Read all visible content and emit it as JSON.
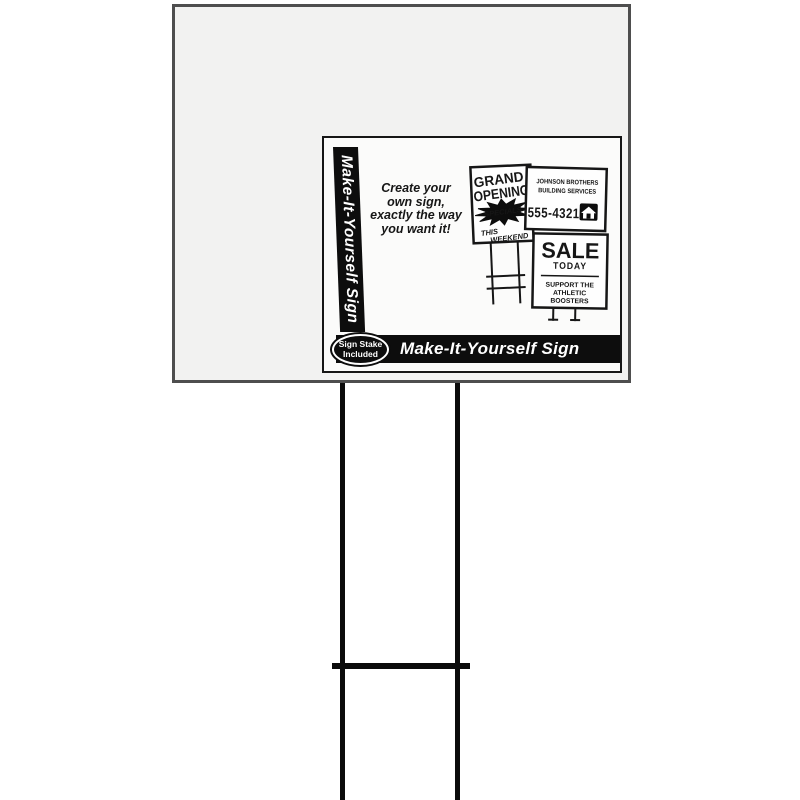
{
  "colors": {
    "background": "#ffffff",
    "sign_fill": "#f2f2f1",
    "label_fill": "#fbfbfa",
    "ink": "#161616",
    "bar_black": "#0d0d0d"
  },
  "label": {
    "side_bar_text": "Make-It-Yourself Sign",
    "tagline": {
      "line1": "Create your",
      "line2": "own sign,",
      "line3": "exactly the way",
      "line4": "you want it!"
    },
    "stake_badge": {
      "line1": "Sign Stake",
      "line2": "Included"
    },
    "bottom_bar_text": "Make-It-Yourself Sign",
    "samples": {
      "grand": {
        "line1": "GRAND",
        "line2": "OPENING",
        "burst": "SPECIALS",
        "line3": "THIS",
        "line4": "WEEKEND"
      },
      "builder": {
        "name1": "JOHNSON BROTHERS",
        "name2": "BUILDING SERVICES",
        "phone": "555-4321"
      },
      "sale": {
        "line1": "SALE",
        "line2": "TODAY",
        "line3": "SUPPORT THE",
        "line4": "ATHLETIC",
        "line5": "BOOSTERS"
      }
    }
  }
}
